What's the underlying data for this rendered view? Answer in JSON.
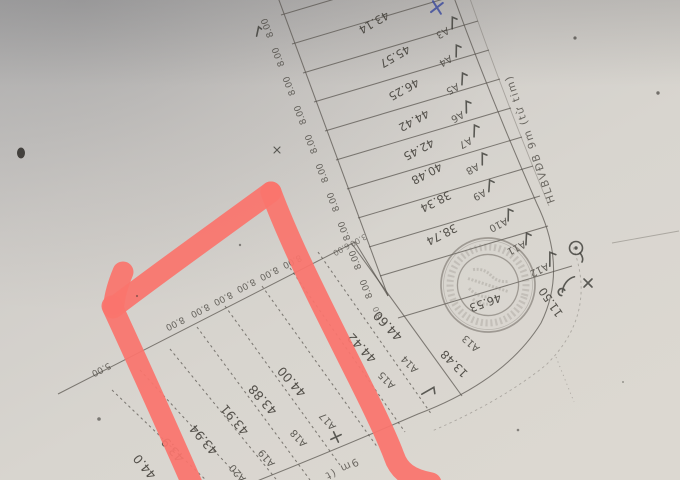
{
  "plan": {
    "road_label_top": "HLBVĐB 9m (từ tim)",
    "road_label_bottom_fragment": "9m (t",
    "upper_lots": [
      {
        "id": "A3",
        "length": "43.14"
      },
      {
        "id": "A4",
        "length": "45.57"
      },
      {
        "id": "A5",
        "length": "46.25"
      },
      {
        "id": "A6",
        "length": "44.42"
      },
      {
        "id": "A7",
        "length": "42.45"
      },
      {
        "id": "A8",
        "length": "40.48"
      },
      {
        "id": "A9",
        "length": "38.34"
      },
      {
        "id": "A10",
        "length": "38.74"
      },
      {
        "id": "A11",
        "length": ""
      },
      {
        "id": "A12",
        "length": ""
      }
    ],
    "corner_lot": {
      "id": "A13",
      "width": "13.48",
      "side": "46.53",
      "frontage": "11.50"
    },
    "lower_lots": [
      {
        "id": "A14",
        "length": "44.60"
      },
      {
        "id": "A15",
        "length": "44.42"
      },
      {
        "id": "A16",
        "length": ""
      },
      {
        "id": "A17",
        "length": "44.00"
      },
      {
        "id": "A18",
        "length": "43.88"
      },
      {
        "id": "A19",
        "length": "43.91"
      },
      {
        "id": "A20",
        "length": "43.94"
      },
      {
        "id": "",
        "length": "43.9"
      },
      {
        "id": "",
        "length": "44.0"
      }
    ],
    "width_labels_upper": [
      "8.00",
      "8.00",
      "8.00",
      "8.00",
      "8.00",
      "8.00",
      "8.00",
      "8.00",
      "8.00",
      "8.00"
    ],
    "width_labels_middle": [
      "8.00",
      "8.00",
      "8.00",
      "8.00",
      "8.00",
      "8.00"
    ],
    "width_labels_extra": {
      "left_partial": "5.00",
      "bend_a": "6.00",
      "bend_b": "3.00",
      "ladder_partial": "8.0"
    }
  },
  "colors": {
    "paper": "#d6d3cd",
    "ink": "#54504a",
    "pen": "#3a3935",
    "blue_pen": "#3f4d9e",
    "red_marker": "#fa746d",
    "stamp_ink": "#6f6962"
  }
}
